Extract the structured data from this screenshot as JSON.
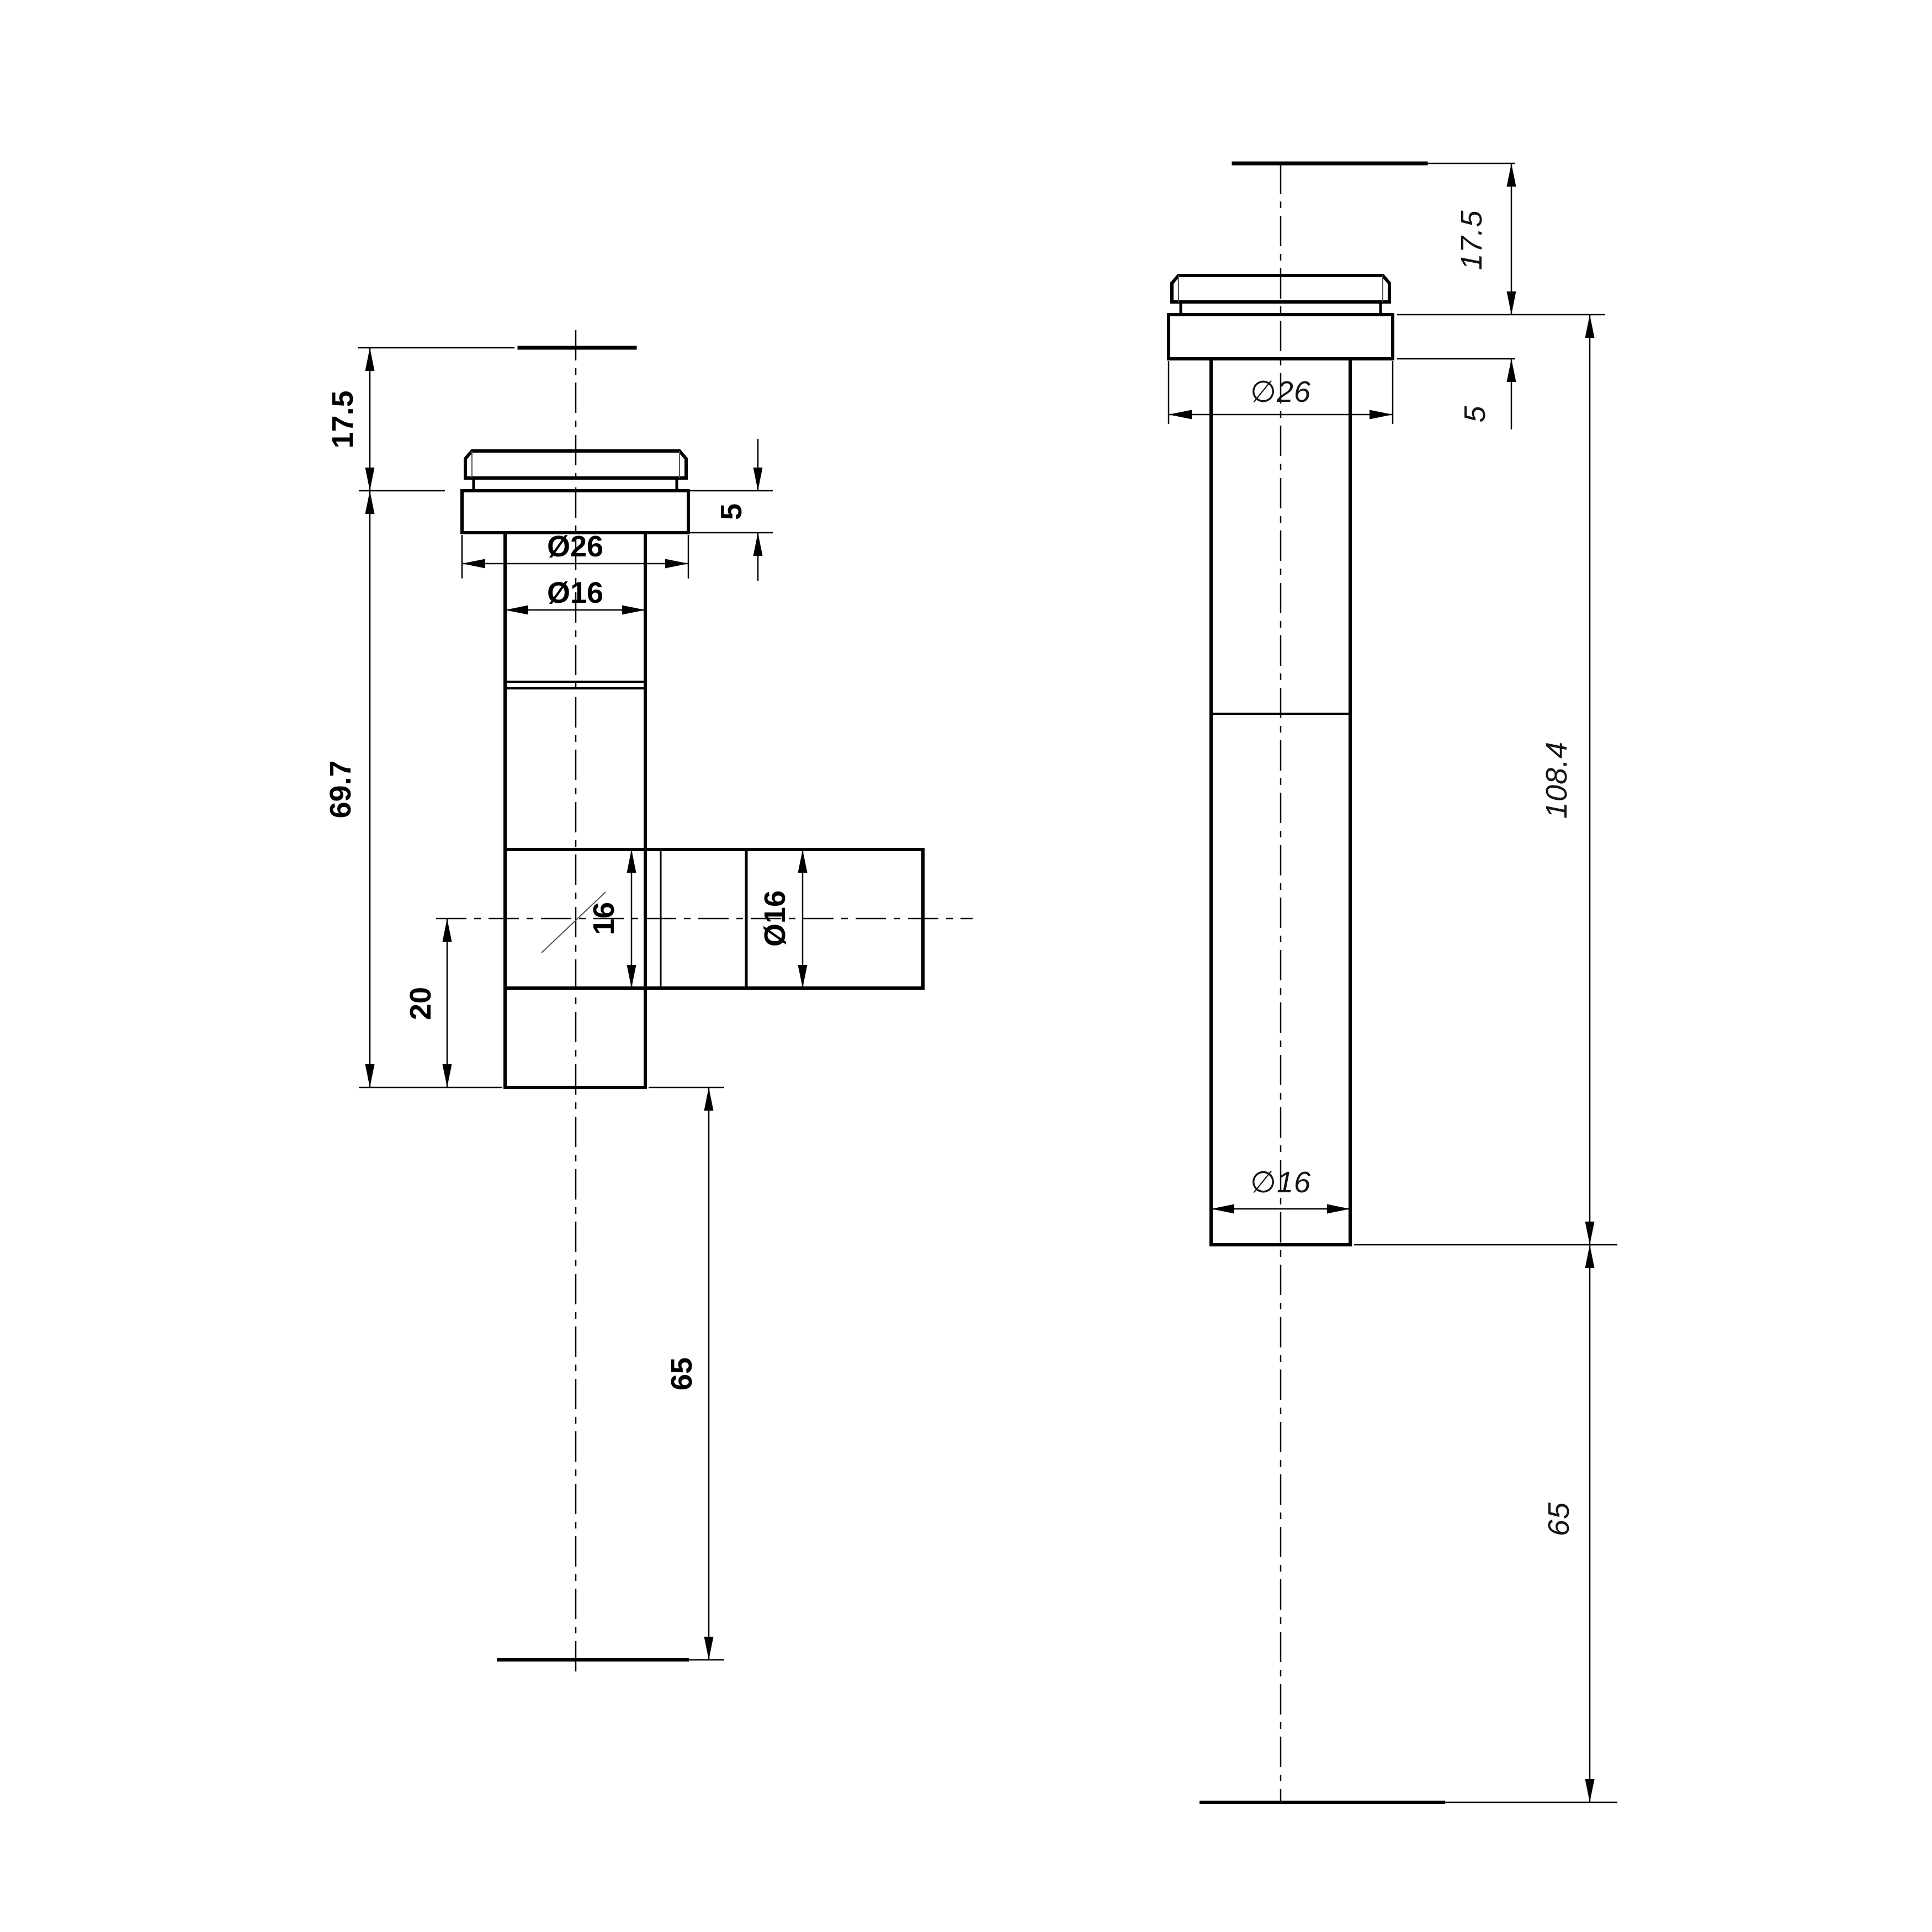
{
  "drawing": {
    "kind": "engineering-cad-dimension-drawing",
    "background_color": "#ffffff",
    "line_color": "#000000",
    "left_view": {
      "name": "front view - tee body with side branch",
      "labels": {
        "cap_height": "17.5",
        "flange_thickness": "5",
        "flange_diameter": "Ø26",
        "shaft_diameter": "Ø16",
        "body_length": "69.7",
        "branch_bore": "16",
        "branch_diameter": "Ø16",
        "branch_axis_offset": "20",
        "tail_length": "65"
      }
    },
    "right_view": {
      "name": "side view - straight body",
      "labels": {
        "cap_height": "17.5",
        "flange_thickness": "5",
        "flange_diameter": "∅26",
        "body_length": "108.4",
        "shaft_diameter": "∅16",
        "tail_length": "65"
      }
    }
  }
}
